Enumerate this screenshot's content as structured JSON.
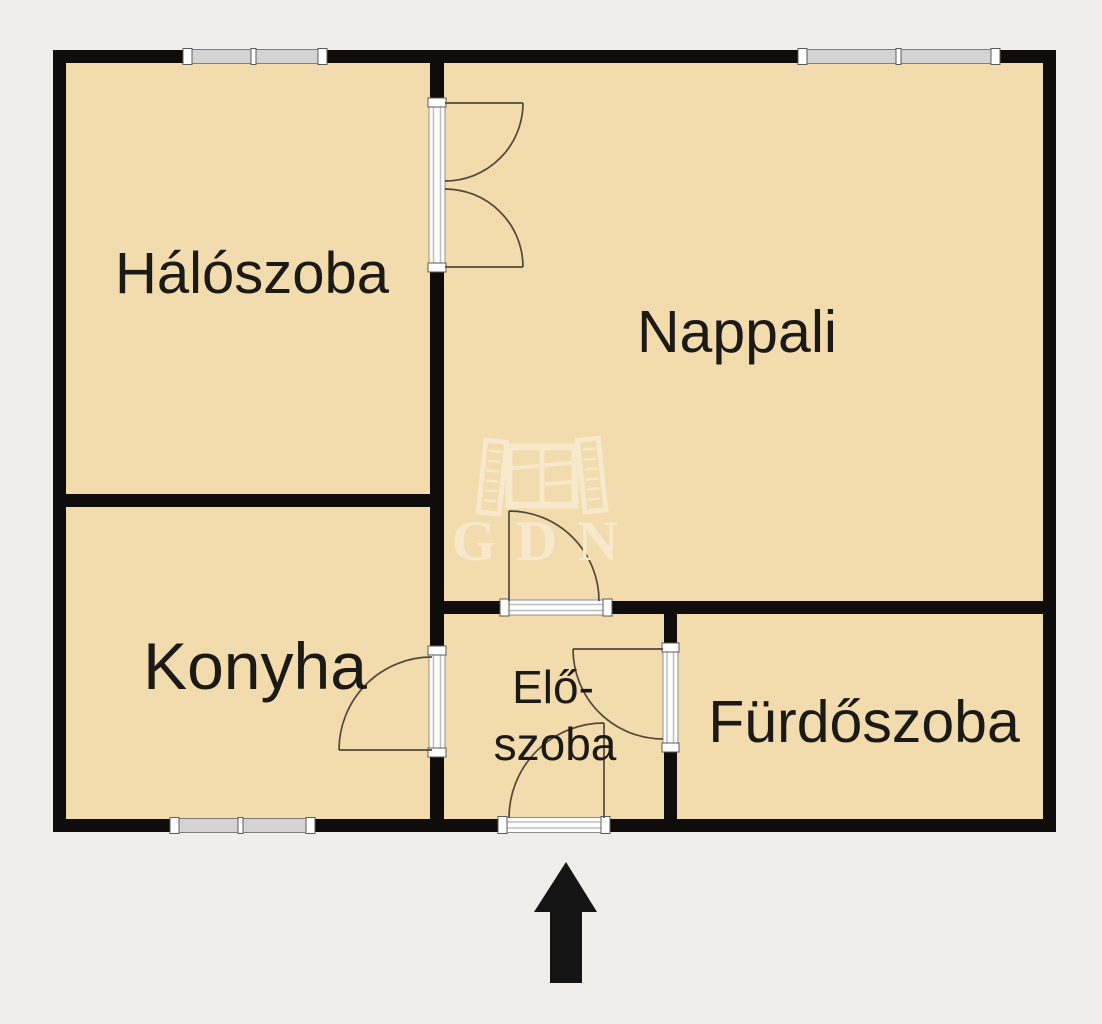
{
  "floorplan": {
    "rooms": [
      {
        "name": "Hálószoba"
      },
      {
        "name": "Nappali"
      },
      {
        "name": "Konyha"
      },
      {
        "name": "Elő-",
        "name_line2": "szoba"
      },
      {
        "name": "Fürdőszoba"
      }
    ],
    "watermark": {
      "text": "GDN",
      "icon": "open-window-icon"
    },
    "entrance": {
      "icon": "arrow-up-icon"
    },
    "colors": {
      "background": "#f0eeea",
      "floor": "#f2dbac",
      "wall": "#0e0d0b",
      "window_glass": "#d4d4d4",
      "door_frame": "#ffffff",
      "door_swing_line": "#54483a",
      "label_text": "#1c1a17",
      "watermark": "#f8e9cc",
      "arrow": "#141414"
    }
  }
}
